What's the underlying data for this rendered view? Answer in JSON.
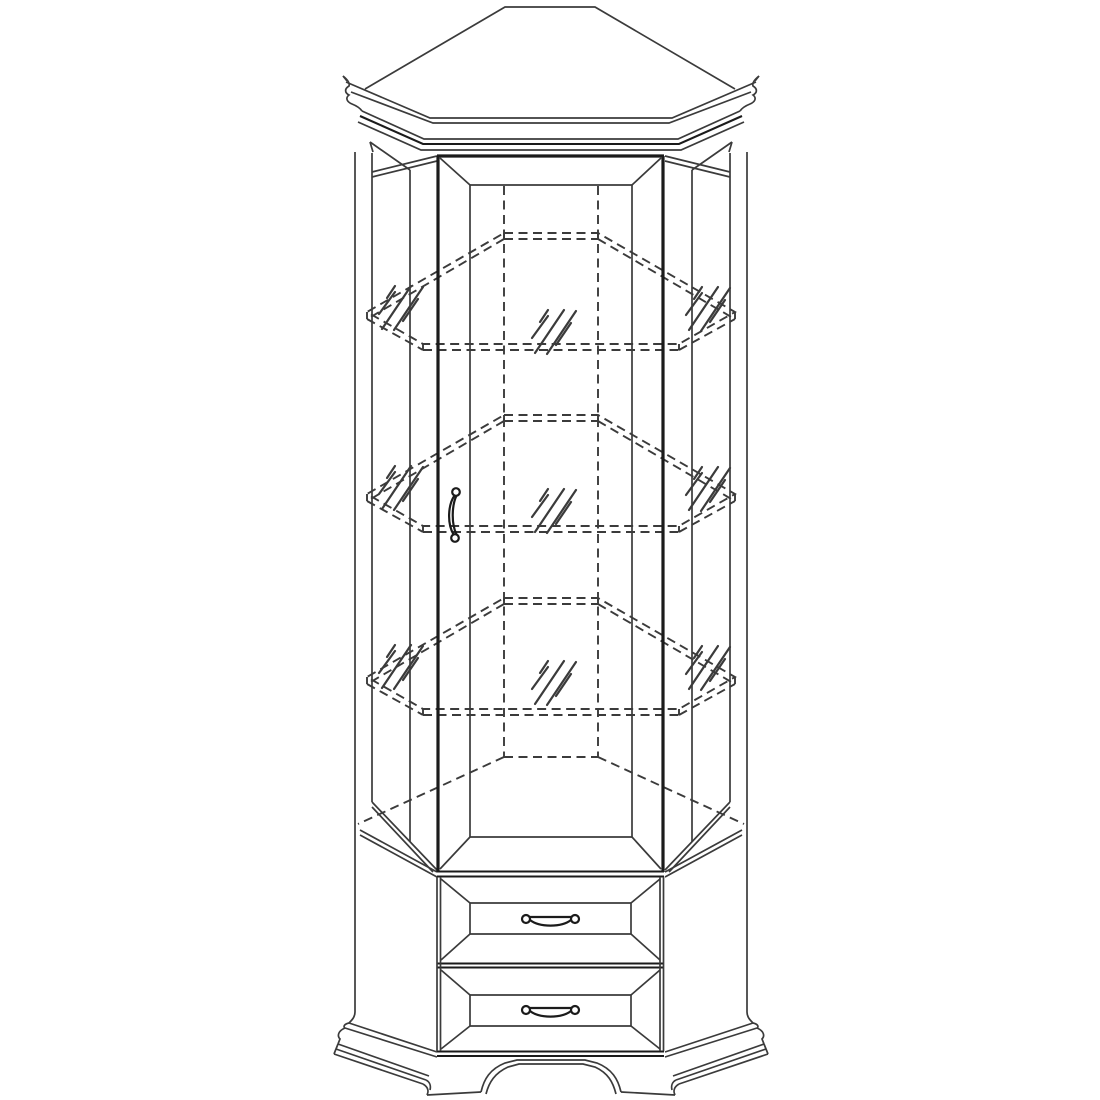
{
  "meta": {
    "kind": "technical line drawing",
    "subject": "tall corner display cabinet",
    "details": "glass door with bevelled frame and bow pull handle, three dashed interior corner shelves with glass shine marks, two bevel-front drawers with bow handles, crown cornice with ogee corner profiles, moulded plinth with bracket feet and arched apron"
  },
  "colors": {
    "background": "#ffffff",
    "ink": "#3b3b3b",
    "ink_strong": "#1b1b1b"
  },
  "counts": {
    "shelves": 3,
    "drawers": 2,
    "doors": 1,
    "handles": 3,
    "glass_shine_marks": 9
  }
}
